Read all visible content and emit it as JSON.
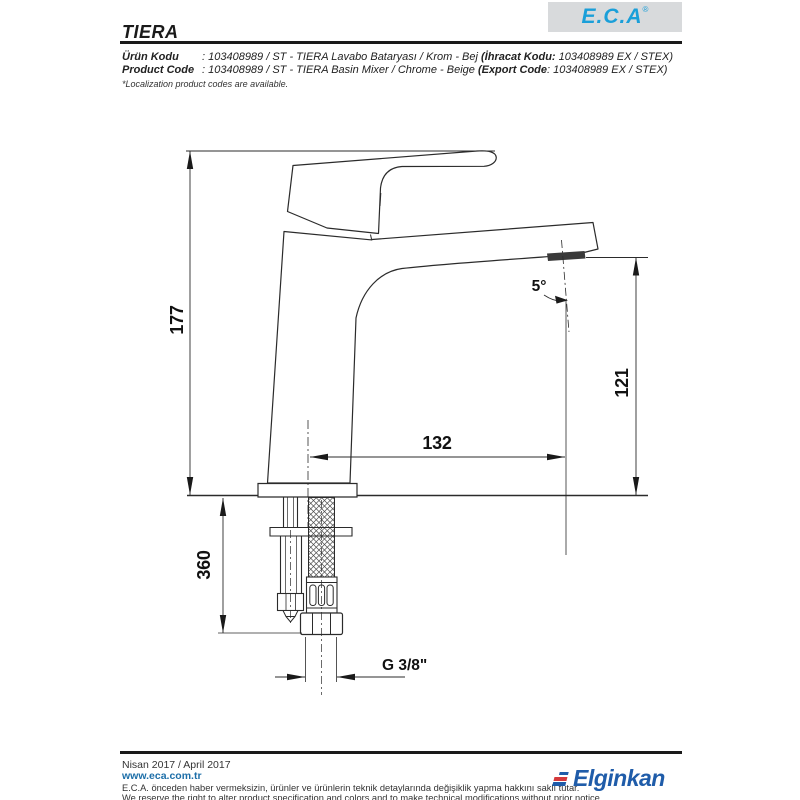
{
  "header": {
    "title": "TIERA",
    "brand": "E.C.A",
    "brand_registered": "®"
  },
  "product_info": {
    "line1_label": "Ürün Kodu",
    "line1_rest": ": 103408989 / ST - TIERA Lavabo Bataryası / Krom - Bej ",
    "line1_export_label": "(İhracat Kodu:",
    "line1_export_value": " 103408989 EX / STEX)",
    "line2_label": "Product Code",
    "line2_rest": ": 103408989 / ST - TIERA Basin Mixer / Chrome - Beige ",
    "line2_export_label": "(Export Code",
    "line2_export_value": ": 103408989 EX / STEX)",
    "note": "*Localization product codes are available."
  },
  "drawing": {
    "dim_total_height": "177",
    "dim_spout_height": "121",
    "dim_spout_reach": "132",
    "dim_hose_length": "360",
    "dim_thread": "G 3/8\"",
    "dim_angle": "5°"
  },
  "footer": {
    "date": "Nisan 2017 / April 2017",
    "website": "www.eca.com.tr",
    "disclaimer_tr": "E.C.A. önceden haber vermeksizin, ürünler ve ürünlerin teknik detaylarında değişiklik yapma hakkını saklı tutar.",
    "disclaimer_en": "We reserve the right to alter product specification and colors and to make technical modifications without prior notice.",
    "brand": "Elginkan"
  },
  "colors": {
    "eca_blue": "#1A9FD9",
    "link_blue": "#1C6EA8",
    "elginkan_blue": "#1F5CA9",
    "elginkan_red": "#D4393C",
    "line": "#2B2B2B"
  }
}
